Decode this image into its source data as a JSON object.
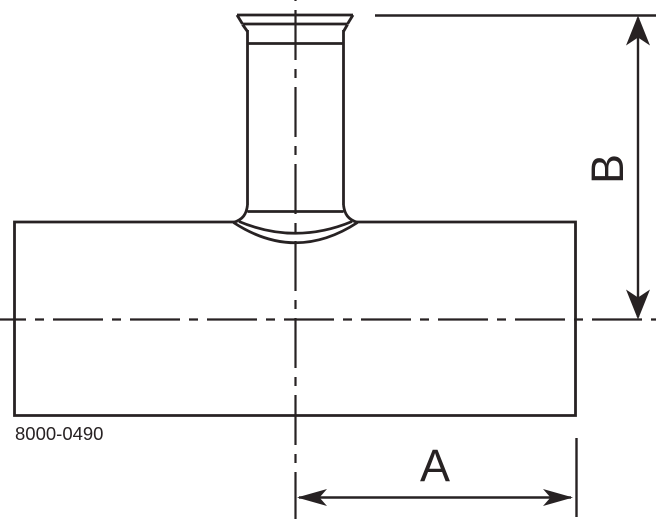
{
  "drawing": {
    "part_number": "8000-0490",
    "dimensions": {
      "horizontal_label": "A",
      "vertical_label": "B"
    },
    "line_color": "#272223",
    "background_color": "#ffffff"
  }
}
